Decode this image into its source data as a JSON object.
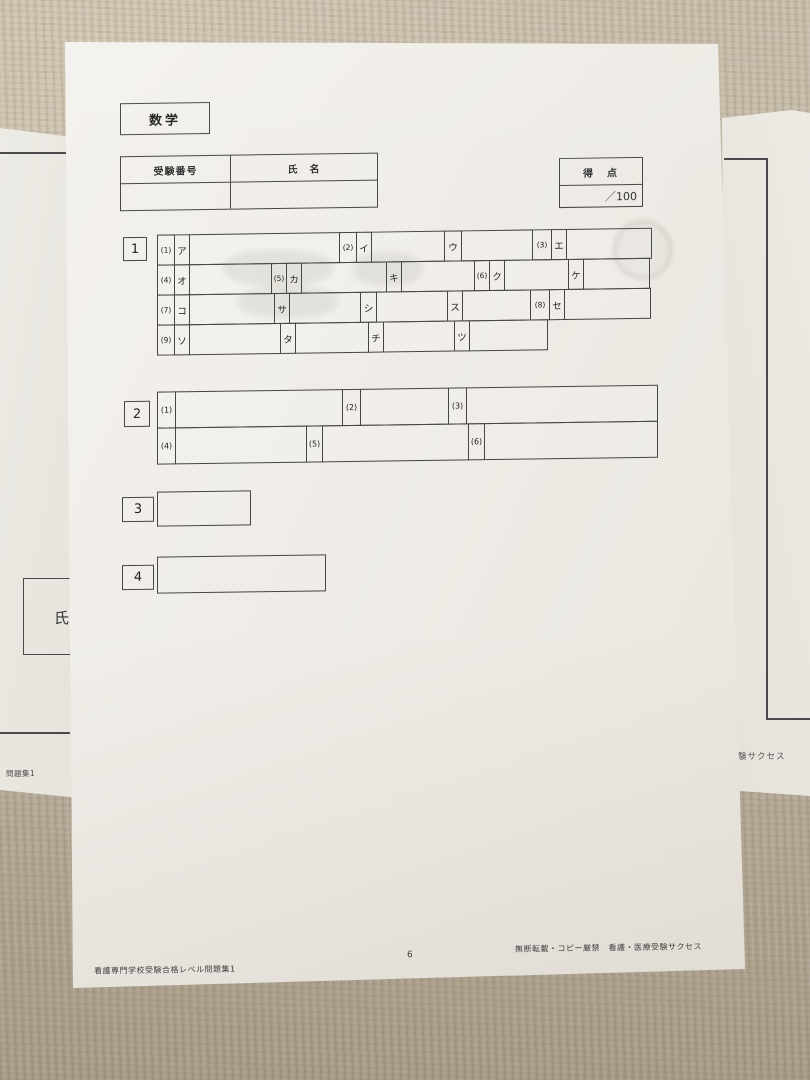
{
  "sheet": {
    "subject": "数学",
    "header_table": {
      "exam_number_label": "受験番号",
      "name_label": "氏　名"
    },
    "score_box": {
      "label": "得　点",
      "value": "／100"
    },
    "q1": {
      "number": "1",
      "row1": [
        "(1)",
        "ア",
        "(2)",
        "イ",
        "ウ",
        "(3)",
        "エ"
      ],
      "row2": [
        "(4)",
        "オ",
        "(5)",
        "カ",
        "キ",
        "(6)",
        "ク",
        "ケ"
      ],
      "row3": [
        "(7)",
        "コ",
        "サ",
        "シ",
        "ス",
        "(8)",
        "セ"
      ],
      "row4": [
        "(9)",
        "ソ",
        "タ",
        "チ",
        "ツ"
      ]
    },
    "q2": {
      "number": "2",
      "row1": [
        "(1)",
        "(2)",
        "(3)"
      ],
      "row2": [
        "(4)",
        "(5)",
        "(6)"
      ]
    },
    "q3": {
      "number": "3"
    },
    "q4": {
      "number": "4"
    },
    "footer": {
      "left": "看護専門学校受験合格レベル問題集1",
      "page": "6",
      "right": "無断転載・コピー厳禁　看護・医療受験サクセス"
    }
  },
  "left_sheet": {
    "name_label": "氏",
    "footer_fragment": "問題集1"
  },
  "right_sheet": {
    "text_fragment": "験サクセス"
  }
}
